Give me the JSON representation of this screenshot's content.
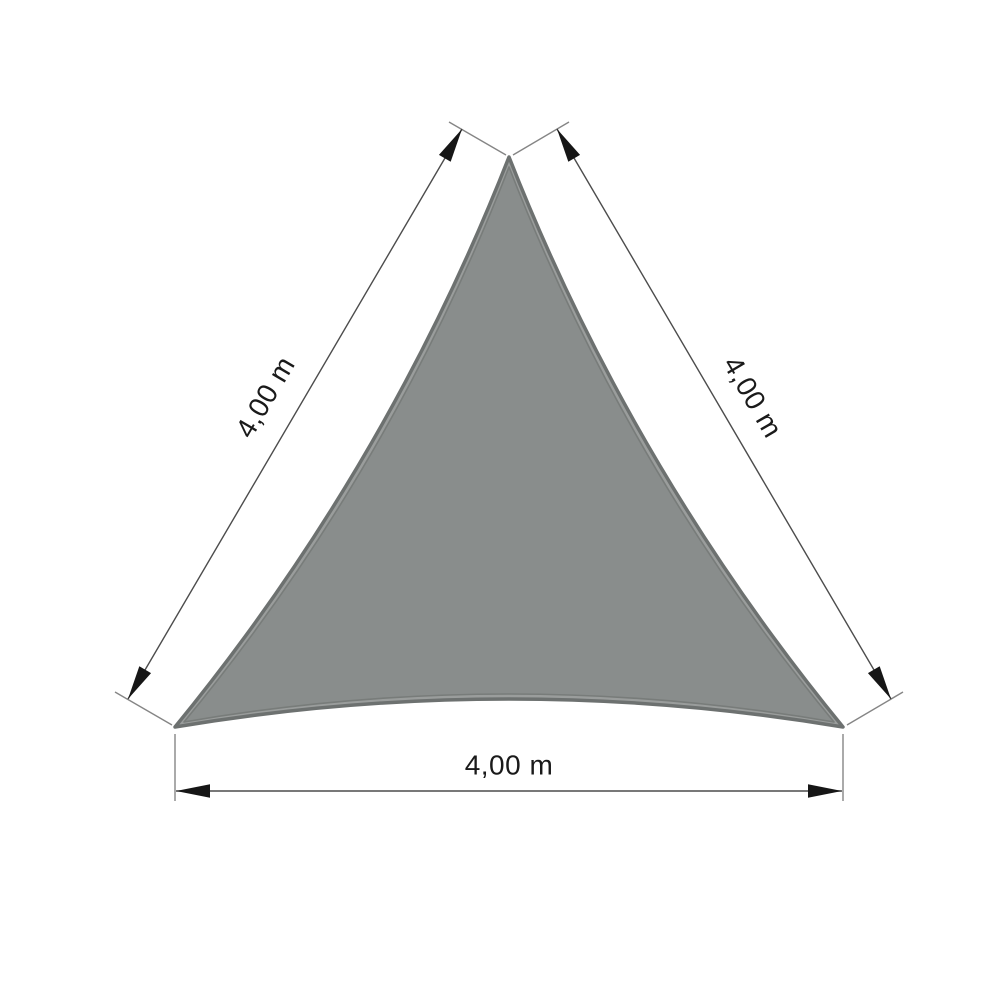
{
  "diagram": {
    "kind": "triangular-shade-sail-dimension-drawing",
    "shape": "equilateral triangle",
    "unit": "m",
    "side_length": "4,00",
    "sides": {
      "left": {
        "label": "4,00 m"
      },
      "right": {
        "label": "4,00 m"
      },
      "bottom": {
        "label": "4,00 m"
      }
    },
    "colors": {
      "background": "#FFFFFF",
      "sail_fill": "#898D8C",
      "sail_edge_band": "#9A9D9C",
      "sail_border": "#6D7170",
      "sail_seam": "#787C7A",
      "dimension_line": "#4C4C4C",
      "extension_line": "#858585",
      "arrowhead": "#161616",
      "label_text": "#1A1A1A"
    }
  }
}
